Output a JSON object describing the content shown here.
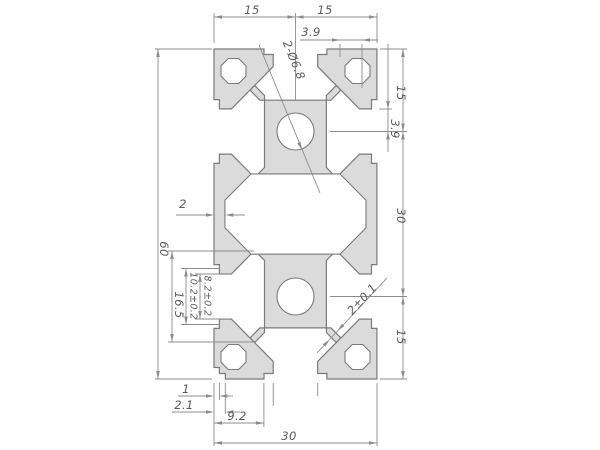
{
  "drawing": {
    "title": "aluminum extrusion profile cross-section",
    "colors": {
      "background": "#ffffff",
      "profile_fill": "#dbdbdb",
      "profile_line": "#7a7a7a",
      "dim_line": "#8c8c8c",
      "text": "#5a5a5a"
    },
    "dimensions": {
      "top_left_15": "15",
      "top_right_15": "15",
      "top_3_9": "3.9",
      "right_top_15": "15",
      "right_3_9": "3.9",
      "right_mid_30": "30",
      "right_bottom_15": "15",
      "left_60": "60",
      "wall_2": "2",
      "slot_16_5": "16.5",
      "slot_10_2": "10.2±0.2",
      "slot_8_2": "8.2±0.2",
      "bottom_1": "1",
      "bottom_2_1": "2.1",
      "bottom_9_2": "9.2",
      "bottom_30": "30",
      "holes_leader": "2-Ø6.8",
      "web_2": "2±0.1"
    }
  }
}
